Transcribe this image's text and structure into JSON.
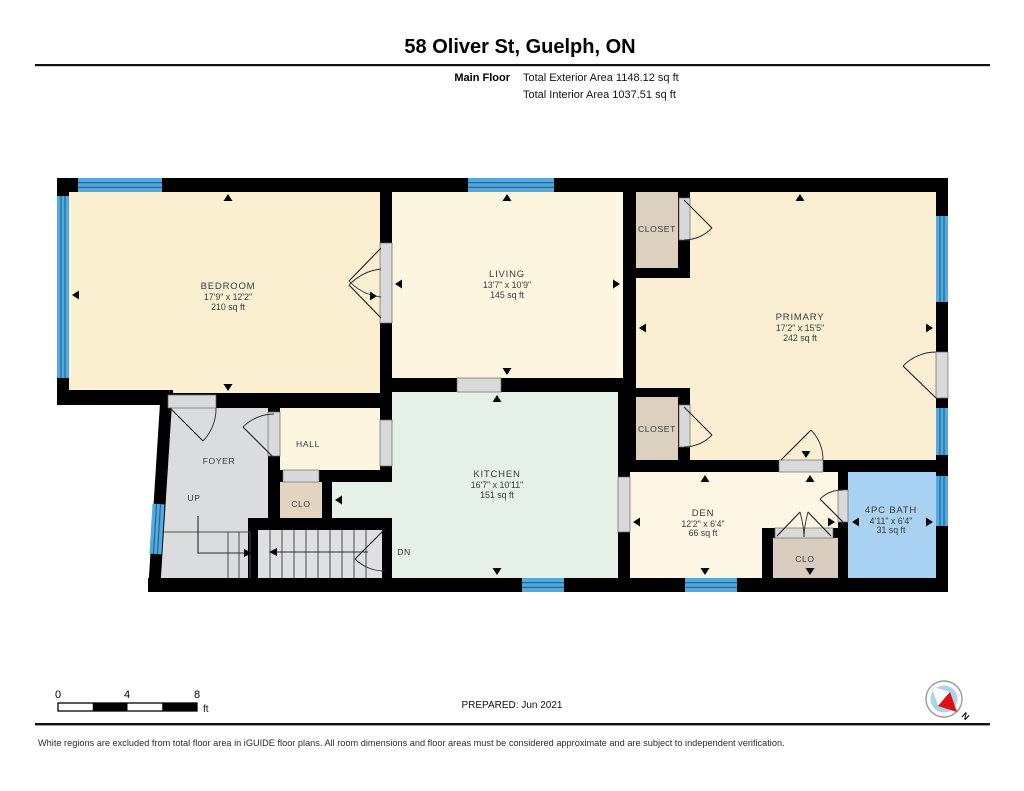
{
  "header": {
    "address": "58 Oliver St, Guelph, ON",
    "floor_label": "Main Floor",
    "total_exterior": "Total Exterior Area 1148.12 sq ft",
    "total_interior": "Total Interior Area 1037.51 sq ft"
  },
  "rooms": [
    {
      "name": "BEDROOM",
      "dims": "17'9\" x 12'2\"",
      "area": "210 sq ft"
    },
    {
      "name": "LIVING",
      "dims": "13'7\" x 10'9\"",
      "area": "145 sq ft"
    },
    {
      "name": "PRIMARY",
      "dims": "17'2\" x 15'5\"",
      "area": "242 sq ft"
    },
    {
      "name": "KITCHEN",
      "dims": "16'7\" x 10'11\"",
      "area": "151 sq ft"
    },
    {
      "name": "DEN",
      "dims": "12'2\" x 6'4\"",
      "area": "66 sq ft"
    },
    {
      "name": "4PC BATH",
      "dims": "4'11\" x 6'4\"",
      "area": "31 sq ft"
    }
  ],
  "labels": {
    "foyer": "FOYER",
    "hall": "HALL",
    "up": "UP",
    "dn": "DN",
    "closet": "CLOSET",
    "clo": "CLO"
  },
  "scale_bar": {
    "ticks": [
      "0",
      "4",
      "8"
    ],
    "unit": "ft"
  },
  "footer": {
    "prepared": "PREPARED: Jun 2021",
    "compass_north": "N",
    "disclaimer": "White regions are excluded from total floor area in iGUIDE floor plans. All room dimensions and floor areas must be considered approximate and are subject to independent verification."
  },
  "colors": {
    "wall": "#000000",
    "window_blue": "#55A8DA",
    "bath_blue": "#A9D2F2",
    "kitchen_mint": "#E5F0E8",
    "bedroom_cream": "#FAEFD0",
    "living_cream": "#FCF5E0",
    "den_cream": "#FDF6E4",
    "closet_tan": "#DCD1C0",
    "foyer_gray": "#DBDCDD",
    "door_gray": "#D9D9D9",
    "compass_red": "#E01010"
  }
}
